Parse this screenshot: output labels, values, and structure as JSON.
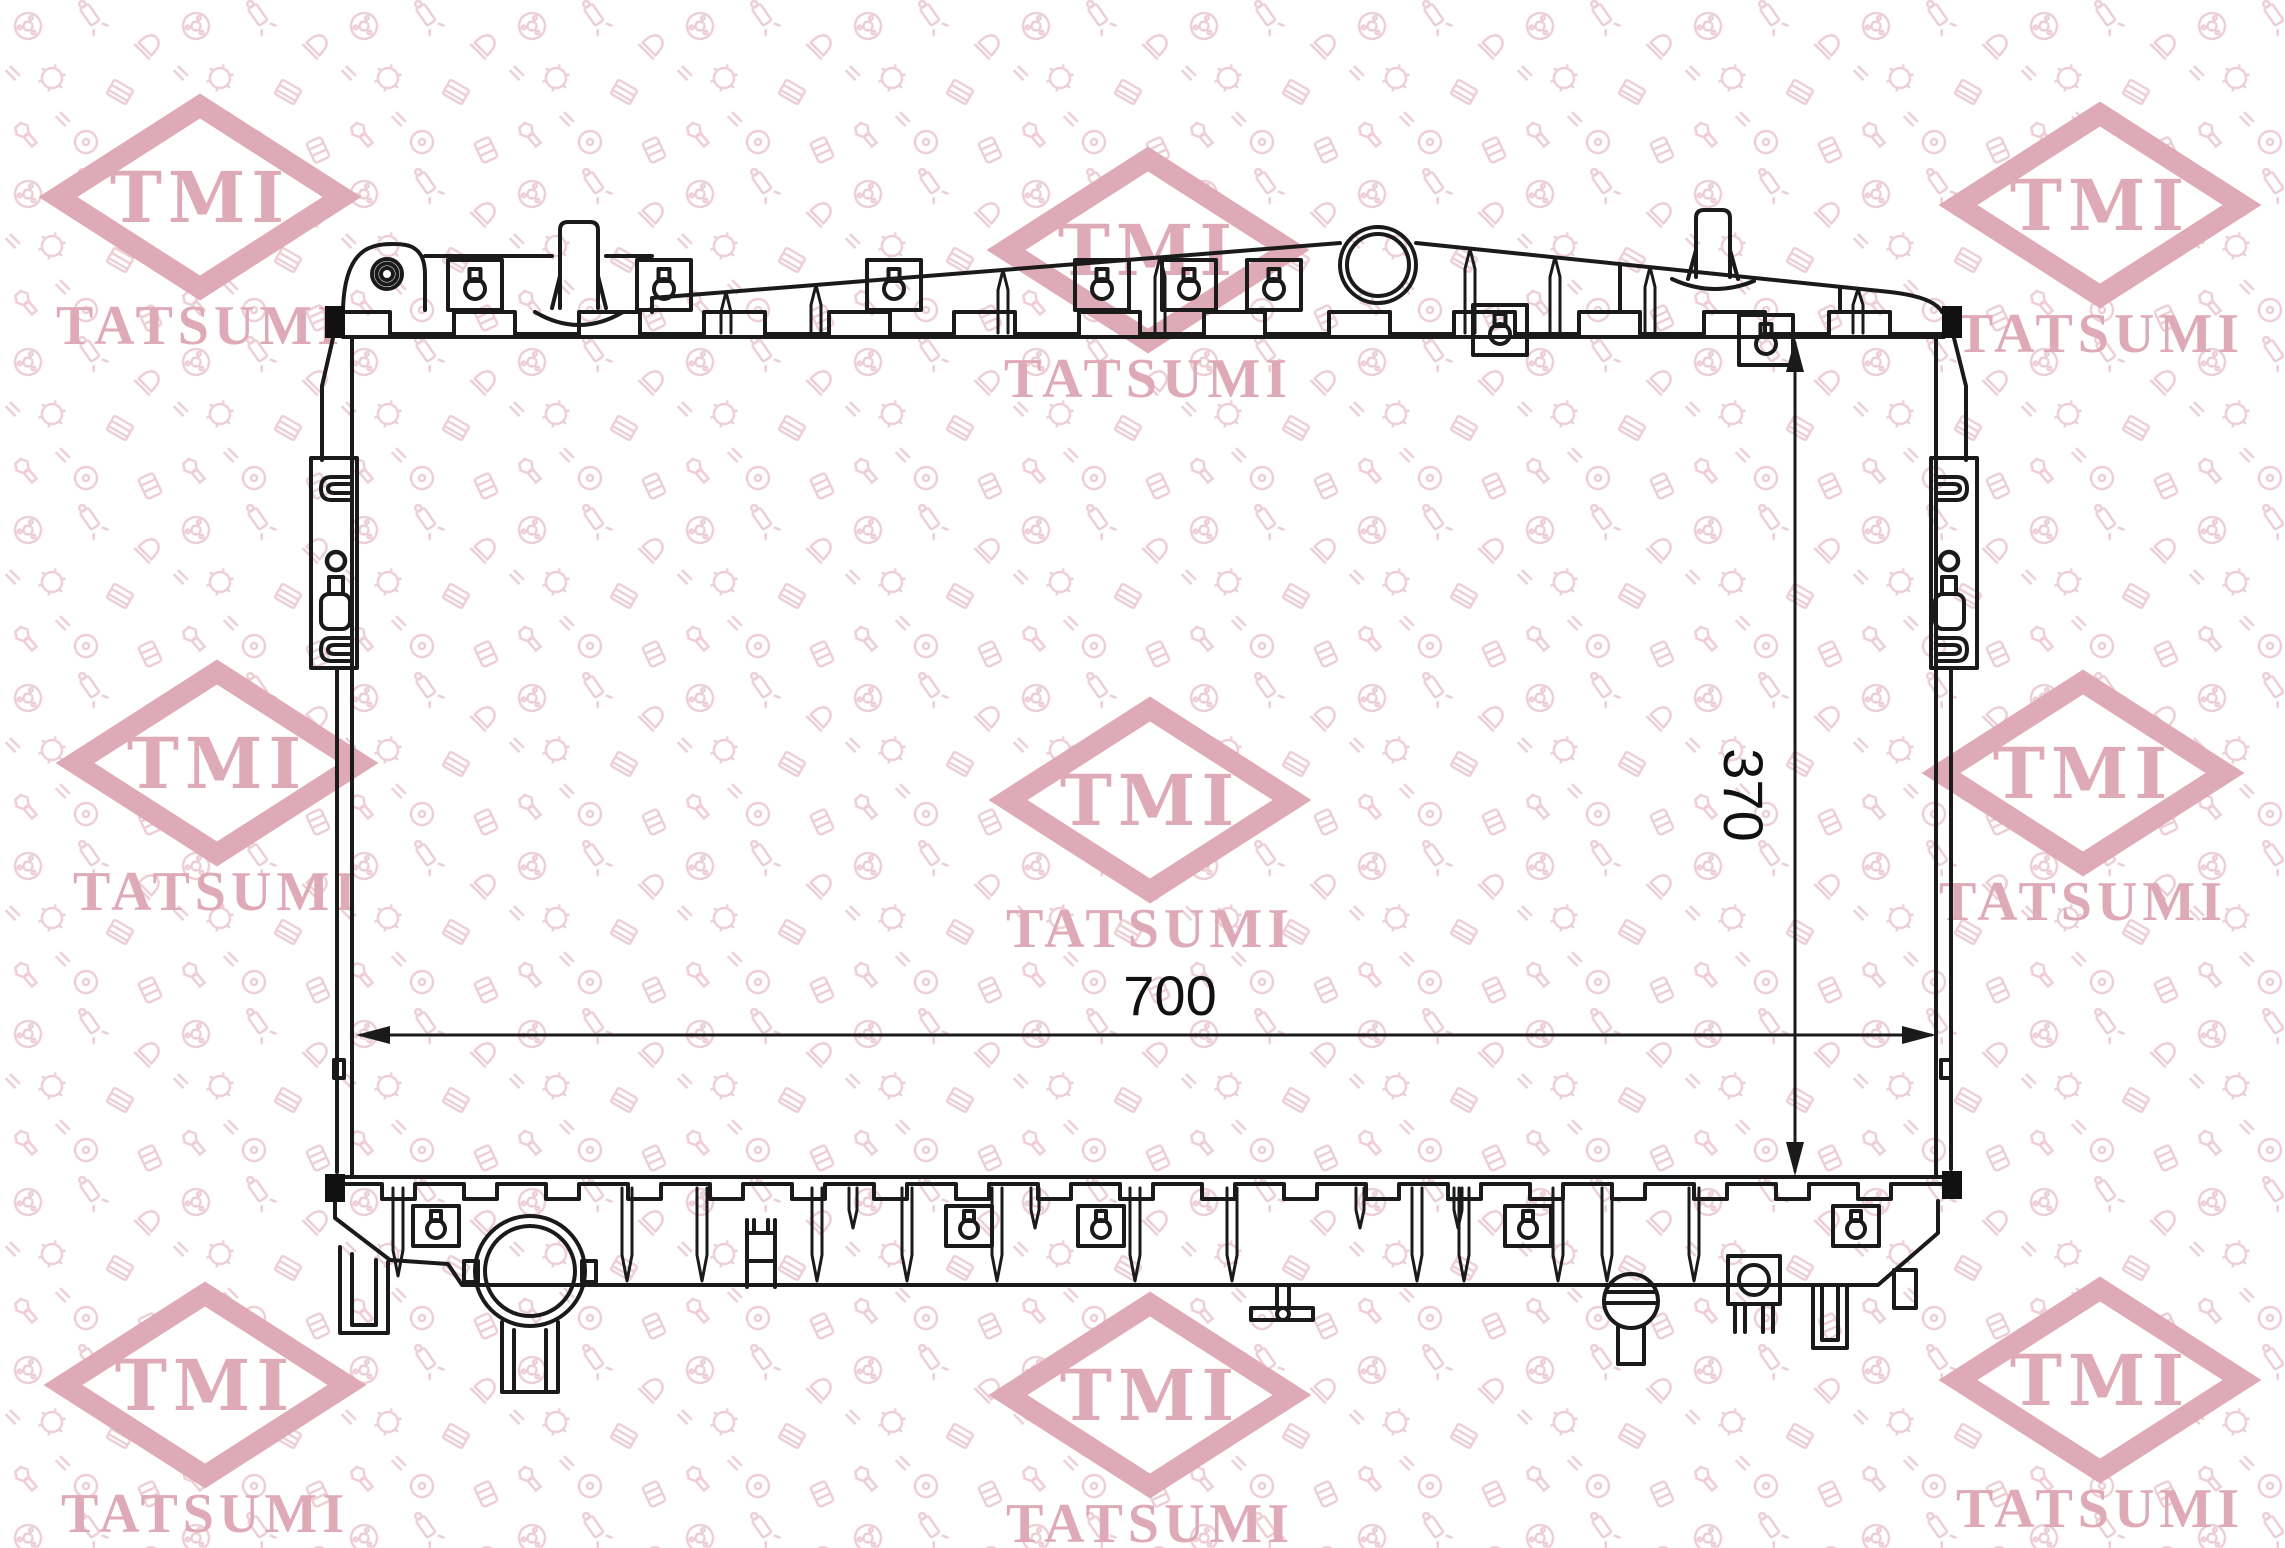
{
  "watermark": {
    "brand": "TMI",
    "company": "TATSUMI",
    "color": "#dfaab7"
  },
  "dimensions": {
    "width": "700",
    "height": "370"
  },
  "colors": {
    "line": "#1a1a1a",
    "pattern": "#eccfd7",
    "watermark_pink": "#dfaab7",
    "background": "#ffffff"
  }
}
